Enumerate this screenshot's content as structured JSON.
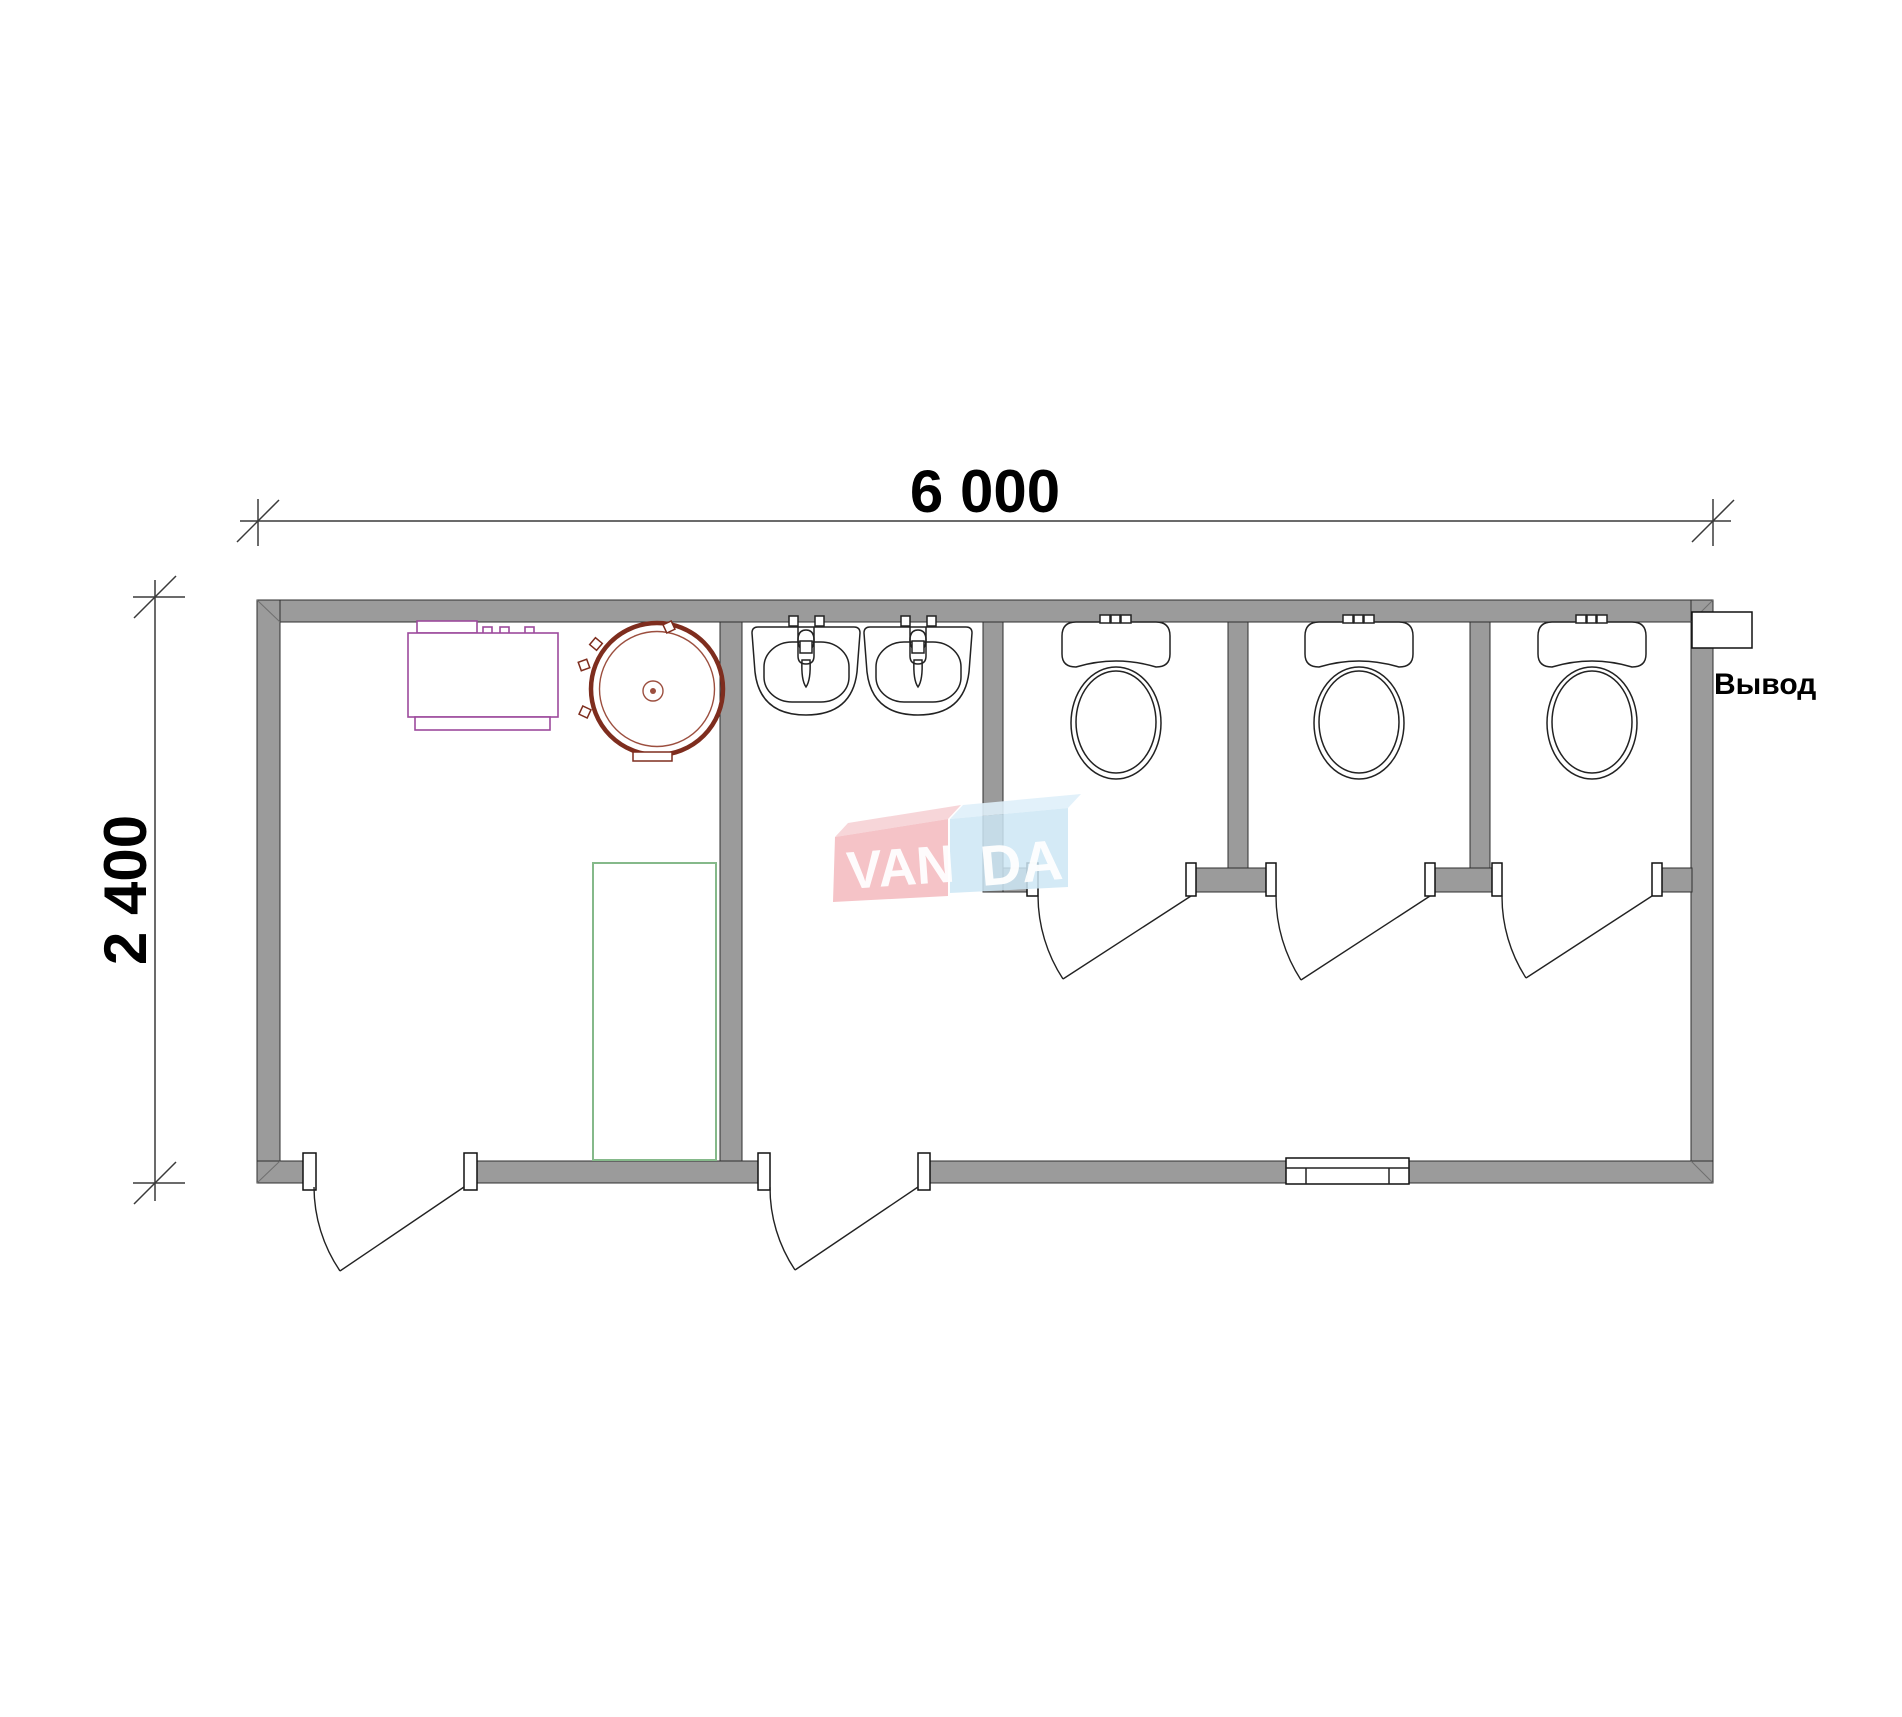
{
  "labels": {
    "width_dimension": "6 000",
    "height_dimension": "2 400",
    "outlet": "Вывод"
  },
  "dimensions_mm": {
    "width": 6000,
    "height": 2400
  },
  "watermark": {
    "text": "VANDA",
    "part1": "VAN",
    "part2": "DA"
  },
  "fixtures": [
    "boiler-unit",
    "round-water-tank",
    "shower-tray",
    "washbasin",
    "washbasin",
    "toilet",
    "toilet",
    "toilet",
    "outlet-box",
    "window-vent",
    "entrance-door",
    "entrance-door",
    "stall-door",
    "stall-door",
    "stall-door"
  ],
  "colors": {
    "wall": "#9b9b9b",
    "wall_outline": "#2f2f2f",
    "line": "#222222",
    "dim": "#3a3a3a",
    "boiler_magenta": "#9c4a9c",
    "tank_red": "#7e2d1e",
    "tank_red_light": "#9c4f3f",
    "shower_green": "#85b98a",
    "wm_pink": "#f3b9bd",
    "wm_pink_light": "#f6d2d5",
    "wm_blue": "#cde6f4",
    "wm_blue_light": "#dff0fa",
    "wm_text": "#ffffff"
  }
}
